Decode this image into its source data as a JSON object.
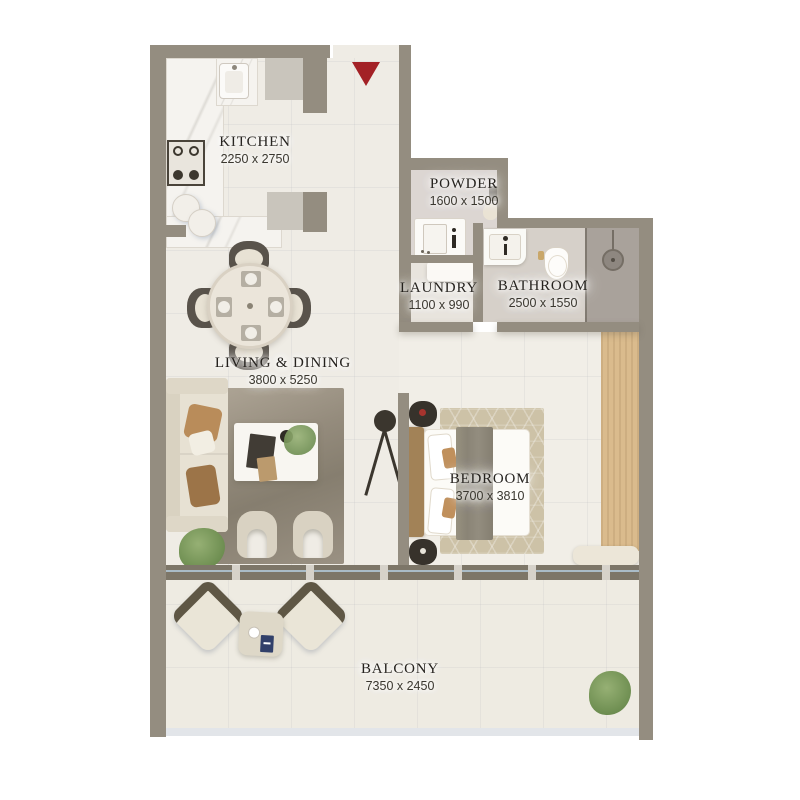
{
  "plan_title": "Apartment floor plan",
  "rooms": {
    "kitchen": {
      "name": "KITCHEN",
      "dims": "2250 x 2750"
    },
    "powder": {
      "name": "POWDER",
      "dims": "1600 x 1500"
    },
    "laundry": {
      "name": "LAUNDRY",
      "dims": "1100 x 990"
    },
    "bathroom": {
      "name": "BATHROOM",
      "dims": "2500 x 1550"
    },
    "living_dining": {
      "name": "LIVING & DINING",
      "dims": "3800 x 5250"
    },
    "bedroom": {
      "name": "BEDROOM",
      "dims": "3700 x 3810"
    },
    "balcony": {
      "name": "BALCONY",
      "dims": "7350 x 2450"
    }
  },
  "entrance": {
    "icon": "entrance-arrow-down"
  },
  "colors": {
    "wall": "#948d80",
    "wall_light": "#c9c5bc",
    "floor": "#efece5",
    "floor_bedroom": "#f1eee7",
    "floor_powder": "#dcd6d2",
    "floor_laundry": "#e8e4dd",
    "floor_bathroom": "#d6d0c9",
    "floor_shower": "#a9a29b",
    "floor_balcony": "#eeebe2",
    "marble": "#f5f3ef",
    "door_frame": "#7d7668",
    "glass": "#b9cbd9",
    "accent_red": "#a32126",
    "rug_living": "#968d7e",
    "rug_bedroom": "#cdc2a7",
    "wood": "#dabb8d",
    "sofa": "#e7e1d3",
    "ink": "#23201c"
  }
}
